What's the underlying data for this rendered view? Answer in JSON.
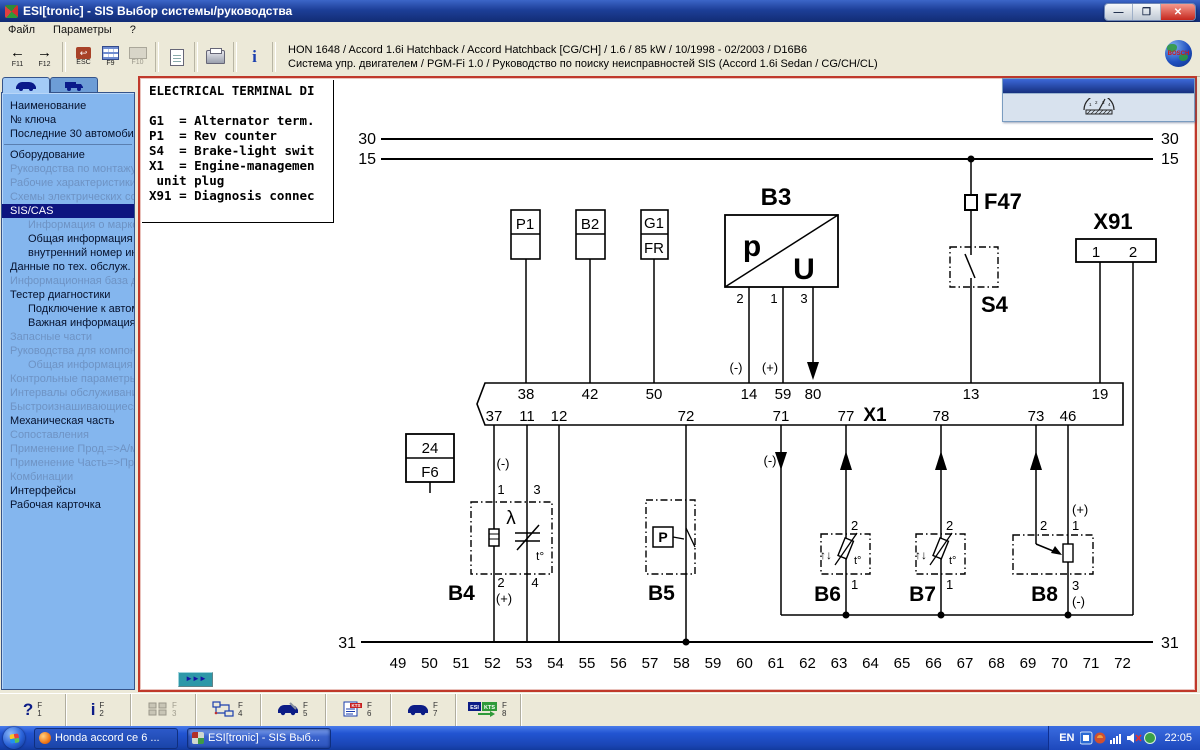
{
  "window": {
    "title": "ESI[tronic] - SIS Выбор системы/руководства",
    "minimize": "—",
    "maximize": "❐",
    "close": "✕"
  },
  "menu": {
    "items": [
      "Файл",
      "Параметры",
      "?"
    ]
  },
  "toolbar": {
    "back_glyph": "←",
    "fwd_glyph": "→",
    "f11": "F11",
    "f12": "F12",
    "esc_label": "ESC",
    "esc_glyph": "↩",
    "f9": "F9",
    "f10": "F10",
    "info_icon": "i",
    "info_line1": "HON 1648 / Accord 1.6i Hatchback / Accord Hatchback [CG/CH] / 1.6 / 85 kW / 10/1998 - 02/2003 / D16B6",
    "info_line2": "Система упр. двигателем / PGM-Fi 1.0 / Руководство по поиску неисправностей SIS  (Accord 1.6i Sedan /  CG/CH/CL)",
    "brand": "BOSCH"
  },
  "sidebar": {
    "items": [
      {
        "label": "Наименование",
        "state": "normal"
      },
      {
        "label": "№ ключа",
        "state": "normal"
      },
      {
        "label": "Последние 30 автомобилей",
        "state": "normal"
      },
      {
        "separator": true
      },
      {
        "label": "Оборудование",
        "state": "normal"
      },
      {
        "label": "Руководства по монтажу",
        "state": "disabled"
      },
      {
        "label": "Рабочие характеристики",
        "state": "disabled"
      },
      {
        "label": "Схемы электрических со...",
        "state": "disabled"
      },
      {
        "label": "SIS/CAS",
        "state": "selected"
      },
      {
        "label": "Информация о марке",
        "state": "disabled",
        "indent": true
      },
      {
        "label": "Общая информация",
        "state": "normal",
        "indent": true
      },
      {
        "label": "внутренний номер инс...",
        "state": "normal",
        "indent": true
      },
      {
        "label": "Данные по тех. обслуж.",
        "state": "normal"
      },
      {
        "label": "Информационная база да...",
        "state": "disabled"
      },
      {
        "label": "Тестер диагностики",
        "state": "normal"
      },
      {
        "label": "Подключение к автом...",
        "state": "normal",
        "indent": true
      },
      {
        "label": "Важная информация",
        "state": "normal",
        "indent": true
      },
      {
        "label": "Запасные части",
        "state": "disabled"
      },
      {
        "label": "Руководства для компон...",
        "state": "disabled"
      },
      {
        "label": "Общая информация",
        "state": "disabled",
        "indent": true
      },
      {
        "label": "Контрольные параметры...",
        "state": "disabled"
      },
      {
        "label": "Интервалы обслуживания",
        "state": "disabled"
      },
      {
        "label": "Быстроизнашивающиеся ...",
        "state": "disabled"
      },
      {
        "label": "Механическая часть",
        "state": "normal"
      },
      {
        "label": "Сопоставления",
        "state": "disabled"
      },
      {
        "label": "Применение Прод.=>А/м.",
        "state": "disabled"
      },
      {
        "label": "Применение Часть=>Прод.",
        "state": "disabled"
      },
      {
        "label": "Комбинации",
        "state": "disabled"
      },
      {
        "label": "Интерфейсы",
        "state": "normal"
      },
      {
        "label": "Рабочая карточка",
        "state": "normal"
      }
    ]
  },
  "legend": {
    "lines": [
      "ELECTRICAL TERMINAL DI",
      "",
      "G1  = Alternator term.",
      "P1  = Rev counter",
      "S4  = Brake-light swit",
      "X1  = Engine-managemen",
      " unit plug",
      "X91 = Diagnosis connec"
    ]
  },
  "diagram": {
    "bus": {
      "top": "30",
      "mid": "15",
      "bottom": "31"
    },
    "labels": {
      "b3": "B3",
      "p": "p",
      "u": "U",
      "f47": "F47",
      "s4": "S4",
      "x91": "X91",
      "x1": "X1",
      "p1": "P1",
      "b2": "B2",
      "g1": "G1",
      "fr": "FR",
      "f6_amp": "24",
      "f6": "F6",
      "b4": "B4",
      "b5": "B5",
      "b6": "B6",
      "b7": "B7",
      "b8": "B8",
      "lambda": "λ",
      "p_sym": "P",
      "t_deg": "t°",
      "updown": "↑↓"
    },
    "x1_top": [
      "38",
      "42",
      "50",
      "14",
      "59",
      "80",
      "13",
      "19"
    ],
    "x1_bottom": [
      "37",
      "11",
      "12",
      "72",
      "71",
      "77",
      "78",
      "73",
      "46"
    ],
    "x91_pins": [
      "1",
      "2"
    ],
    "b3_pins": [
      "2",
      "1",
      "3"
    ],
    "b4_pins": {
      "p1": "1",
      "p3": "3",
      "p2": "2",
      "p4": "4"
    },
    "b6_pins": {
      "top": "2",
      "bottom": "1"
    },
    "b7_pins": {
      "top": "2",
      "bottom": "1"
    },
    "b8_pins": {
      "p2": "2",
      "p1": "1",
      "p3": "3"
    },
    "polarity": {
      "minus": "(-)",
      "plus": "(+)"
    },
    "scale": [
      "49",
      "50",
      "51",
      "52",
      "53",
      "54",
      "55",
      "56",
      "57",
      "58",
      "59",
      "60",
      "61",
      "62",
      "63",
      "64",
      "65",
      "66",
      "67",
      "68",
      "69",
      "70",
      "71",
      "72"
    ],
    "doc_number": "3.000 102 1"
  },
  "panel": {
    "gauge_ticks": [
      "1",
      "2",
      "3",
      "4"
    ]
  },
  "content": {
    "nav_button": "►►►"
  },
  "bottom_toolbar": {
    "f_label": "F",
    "icon_text": {
      "esi": "ESI",
      "kts": "KTS"
    },
    "buttons": [
      {
        "name": "help",
        "glyph": "?",
        "num": "1"
      },
      {
        "name": "info",
        "glyph": "i",
        "num": "2"
      },
      {
        "name": "parts",
        "glyph": "",
        "num": "3",
        "disabled": true
      },
      {
        "name": "wiring",
        "glyph": "",
        "num": "4"
      },
      {
        "name": "vehicle-service",
        "glyph": "",
        "num": "5"
      },
      {
        "name": "kts-document",
        "glyph": "",
        "num": "6"
      },
      {
        "name": "vehicle",
        "glyph": "",
        "num": "7"
      },
      {
        "name": "esi-to-kts",
        "glyph": "",
        "num": "8"
      }
    ]
  },
  "taskbar": {
    "tasks": [
      {
        "label": "Honda accord ce 6 ...",
        "active": false
      },
      {
        "label": "ESI[tronic] - SIS Выб...",
        "active": true
      }
    ],
    "tray": {
      "lang": "EN",
      "clock": "22:05"
    }
  }
}
